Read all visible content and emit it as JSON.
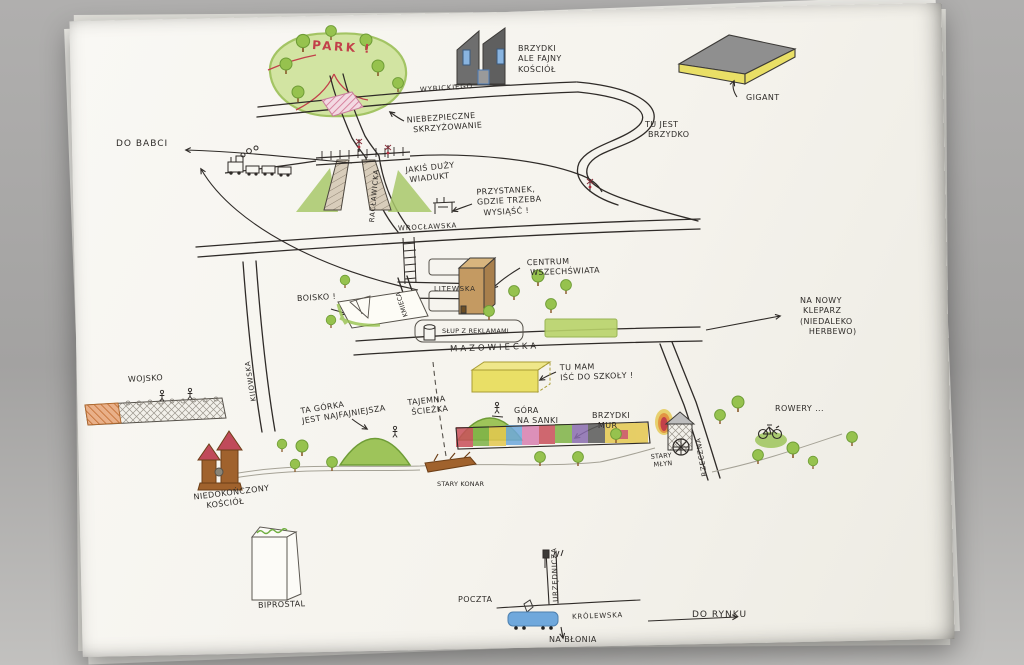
{
  "palette": {
    "background_gray": "#a3a2a1",
    "paper": "#f5f3ed",
    "ink": "#2f2b28",
    "pencil": "#8e8c84",
    "crayon_green": "#96c24e",
    "crayon_dark_green": "#6e9c36",
    "red": "#c2404a",
    "pink_hatch": "#d884a0",
    "yellow": "#e9df66",
    "tram_blue": "#6fa8dc",
    "window_blue": "#89b4e0",
    "brown": "#a0622d",
    "building_gray": "#6a6a6a"
  },
  "labels": {
    "park": "PARK !",
    "wybickiego": "WYBICKIEGO",
    "brzydki_kosciol": "BRZYDKI\nALE FAJNY\nKOŚCIÓŁ",
    "gigant": "GIGANT",
    "tu_jest_brzydko": "TU JEST\n BRZYDKO",
    "do_babci": "DO BABCI",
    "niebezpieczne_skrzyzowanie": "NIEBEZPIECZNE\n  SKRZYŻOWANIE",
    "jakis_duzy_wiadukt": "JAKIŚ DUŻY\n WIADUKT",
    "raclawicka": "RACŁAWICKA",
    "przystanek": "PRZYSTANEK,\nGDZIE TRZEBA\n  WYSIĄŚĆ !",
    "wroclawska": "WROCŁAWSKA",
    "centrum_wszechswiata": "CENTRUM\n WSZECHŚWIATA",
    "litewska": "LITEWSKA",
    "kmieca": "KMIECA",
    "boisko": "BOISKO !",
    "slup_z_reklamami": "SŁUP Z REKLAMAMI",
    "mazowiecka": "MAZOWIECKA",
    "na_nowy_kleparz": "NA NOWY\n KLEPARZ\n(NIEDALEKO\n   HERBEWO)",
    "tu_mam_isc_do_szkoly": "TU MAM\nIŚĆ DO SZKOŁY !",
    "wojsko": "WOJSKO",
    "kijowska": "KIJOWSKA",
    "ta_gorka": "TA GÓRKA\nJEST NAJFAJNIEJSZA",
    "tajemna_sciezka": "TAJEMNA\n ŚCIEŻKA",
    "gora_na_sanki": "GÓRA\n NA SANKI",
    "brzydki_mur": "BRZYDKI\n  MUR",
    "stary_mlyn": "STARY\n MŁYN",
    "rzeczna": "RZECZNA",
    "rowery": "ROWERY ...",
    "niedokonczony_kosciol": "NIEDOKOŃCZONY\n    KOŚCIÓŁ",
    "stary_konar": "STARY KONAR",
    "biprostal": "BIPROSTAL",
    "poczta": "POCZTA",
    "urzednicza": "URZĘDNICZA",
    "krolewska": "KRÓLEWSKA",
    "do_rynku": "DO RYNKU",
    "na_blonia": "NA BŁONIA"
  },
  "drawings": [
    "park-with-trees-and-red-paths",
    "modern-church",
    "gigant-store-slab",
    "steam-train",
    "railway-viaduct-with-embankments",
    "railway-crossing-signals",
    "pink-dangerous-intersection",
    "bus-stop-shelter",
    "stairs-ladder",
    "city-blocks",
    "advertising-column",
    "green-lawn-strip",
    "universe-center-building",
    "yellow-school-building",
    "playing-field-with-goal",
    "military-wall-with-figures",
    "sledding-hills-with-figures",
    "colorful-graffiti-wall",
    "old-mill-with-waterwheel-and-fire",
    "bicycle-on-bush",
    "old-log",
    "unfinished-brick-church",
    "biprostal-tower-with-green-sign",
    "blue-tram",
    "scattered-trees",
    "direction-arrows"
  ]
}
